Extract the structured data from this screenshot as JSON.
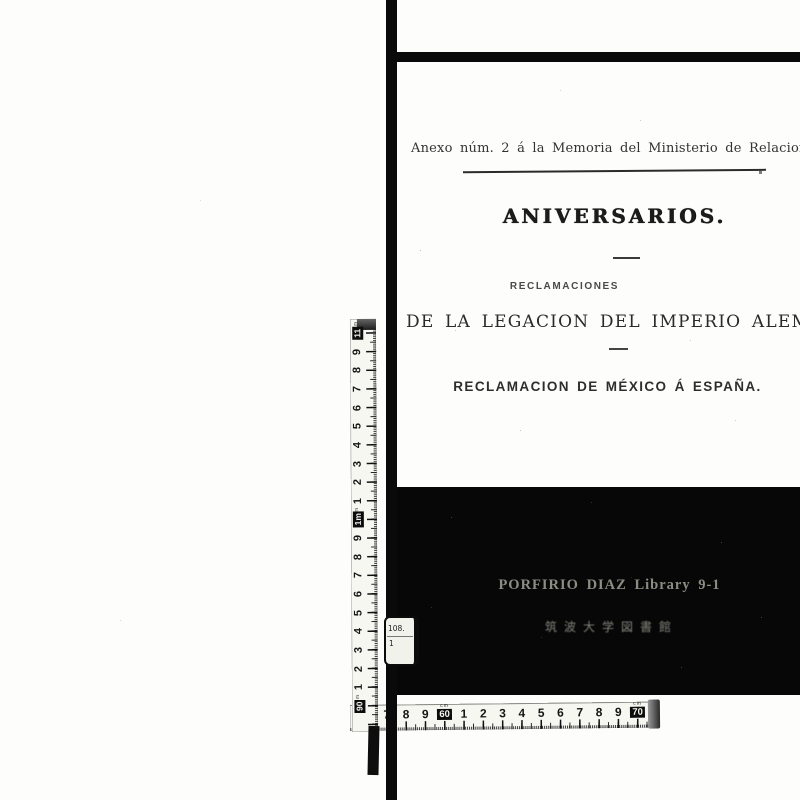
{
  "page": {
    "header_line": "Anexo núm. 2 á la Memoria del Ministerio de Relaciones Exteriores.",
    "title": "ANIVERSARIOS.",
    "subtitle_small": "RECLAMACIONES",
    "subtitle_main": "DE LA LEGACION DEL IMPERIO ALEMAN.",
    "subtitle_secondary": "RECLAMACION DE MÉXICO Á ESPAÑA."
  },
  "stamp_block": {
    "library_line": "PORFIRIO DIAZ Library  9-1",
    "japanese_line": "筑波大学図書館",
    "background": "#070707",
    "text_color": "#8d8c84"
  },
  "sticker": {
    "line1": "108.",
    "line2": "1"
  },
  "vertical_ruler": {
    "unit_label": "m",
    "marks": [
      "11",
      "9",
      "8",
      "7",
      "6",
      "5",
      "4",
      "3",
      "2",
      "1",
      "1m",
      "9",
      "8",
      "7",
      "6",
      "5",
      "4",
      "3",
      "2",
      "1",
      "90"
    ],
    "box_indices": [
      0,
      10,
      20
    ]
  },
  "horizontal_ruler": {
    "unit_label": "cm",
    "marks": [
      "6",
      "7",
      "8",
      "9",
      "60",
      "1",
      "2",
      "3",
      "4",
      "5",
      "6",
      "7",
      "8",
      "9",
      "70"
    ],
    "box_indices": [
      4,
      14
    ]
  }
}
